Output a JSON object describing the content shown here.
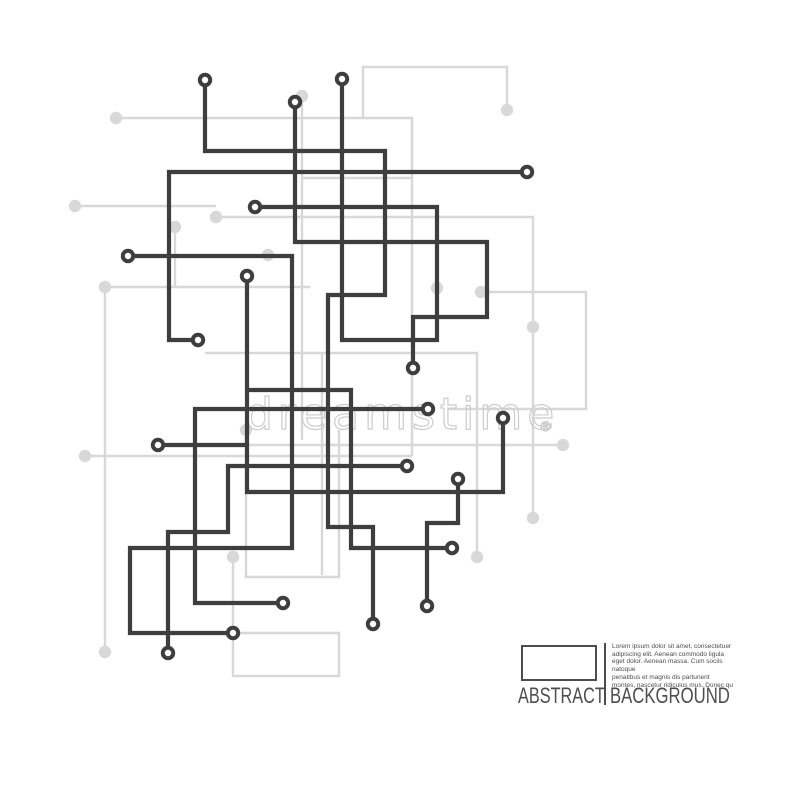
{
  "circuit": {
    "colors": {
      "dark": "#3e3e3e",
      "light": "#d8d8d8",
      "node_fill": "#ffffff",
      "watermark": "#cccccc",
      "caption": "#4d4d4d",
      "background": "#ffffff"
    },
    "dark_line_width": 4.2,
    "light_line_width": 2.4,
    "dark_traces": [
      {
        "name": "trace-top-left-hook",
        "points": [
          [
            205,
            80
          ],
          [
            205,
            151
          ],
          [
            385,
            151
          ],
          [
            385,
            295
          ],
          [
            328,
            295
          ],
          [
            328,
            527
          ],
          [
            373,
            527
          ],
          [
            373,
            624
          ]
        ]
      },
      {
        "name": "trace-center-drop",
        "points": [
          [
            342,
            79
          ],
          [
            342,
            340
          ],
          [
            437,
            340
          ],
          [
            437,
            207
          ],
          [
            255,
            207
          ]
        ]
      },
      {
        "name": "trace-step-rect",
        "points": [
          [
            295,
            102
          ],
          [
            295,
            242
          ],
          [
            487,
            242
          ],
          [
            487,
            317
          ],
          [
            413,
            317
          ],
          [
            413,
            368
          ]
        ]
      },
      {
        "name": "trace-wide-L",
        "points": [
          [
            198,
            340
          ],
          [
            169,
            340
          ],
          [
            169,
            172
          ],
          [
            527,
            172
          ]
        ]
      },
      {
        "name": "trace-left-long",
        "points": [
          [
            128,
            256
          ],
          [
            292,
            256
          ],
          [
            292,
            548
          ],
          [
            130,
            548
          ],
          [
            130,
            633
          ],
          [
            233,
            633
          ]
        ]
      },
      {
        "name": "trace-mid-horizontal",
        "points": [
          [
            428,
            409
          ],
          [
            195,
            409
          ],
          [
            195,
            603
          ],
          [
            283,
            603
          ]
        ]
      },
      {
        "name": "trace-small-hook",
        "points": [
          [
            458,
            479
          ],
          [
            458,
            523
          ],
          [
            427,
            523
          ],
          [
            427,
            606
          ]
        ]
      },
      {
        "name": "trace-crossbar",
        "points": [
          [
            247,
            390
          ],
          [
            351,
            390
          ],
          [
            351,
            548
          ],
          [
            452,
            548
          ]
        ]
      },
      {
        "name": "trace-lower-left-hook",
        "points": [
          [
            407,
            466
          ],
          [
            228,
            466
          ],
          [
            228,
            532
          ],
          [
            168,
            532
          ],
          [
            168,
            653
          ]
        ]
      },
      {
        "name": "trace-stub",
        "points": [
          [
            158,
            445
          ],
          [
            247,
            445
          ]
        ]
      },
      {
        "name": "trace-u-shape",
        "points": [
          [
            247,
            276
          ],
          [
            247,
            492
          ],
          [
            503,
            492
          ],
          [
            503,
            418
          ]
        ]
      }
    ],
    "dark_nodes": [
      [
        205,
        80
      ],
      [
        342,
        79
      ],
      [
        295,
        102
      ],
      [
        527,
        172
      ],
      [
        255,
        207
      ],
      [
        128,
        256
      ],
      [
        247,
        276
      ],
      [
        198,
        340
      ],
      [
        413,
        368
      ],
      [
        428,
        409
      ],
      [
        503,
        418
      ],
      [
        158,
        445
      ],
      [
        407,
        466
      ],
      [
        458,
        479
      ],
      [
        452,
        548
      ],
      [
        283,
        603
      ],
      [
        427,
        606
      ],
      [
        373,
        624
      ],
      [
        233,
        633
      ],
      [
        168,
        653
      ]
    ],
    "light_traces": [
      {
        "points": [
          [
            116,
            118
          ],
          [
            412,
            118
          ],
          [
            412,
            456
          ]
        ]
      },
      {
        "points": [
          [
            302,
            96
          ],
          [
            302,
            440
          ]
        ]
      },
      {
        "points": [
          [
            363,
            117
          ],
          [
            363,
            67
          ],
          [
            507,
            67
          ],
          [
            507,
            110
          ]
        ]
      },
      {
        "points": [
          [
            75,
            206
          ],
          [
            216,
            206
          ]
        ]
      },
      {
        "points": [
          [
            216,
            217
          ],
          [
            533,
            217
          ],
          [
            533,
            408
          ]
        ]
      },
      {
        "points": [
          [
            448,
            409
          ],
          [
            586,
            409
          ],
          [
            586,
            292
          ],
          [
            481,
            292
          ]
        ]
      },
      {
        "points": [
          [
            533,
            408
          ],
          [
            533,
            518
          ]
        ]
      },
      {
        "points": [
          [
            85,
            456
          ],
          [
            412,
            456
          ]
        ]
      },
      {
        "points": [
          [
            246,
            430
          ],
          [
            246,
            577
          ],
          [
            339,
            577
          ],
          [
            339,
            430
          ]
        ]
      },
      {
        "points": [
          [
            233,
            557
          ],
          [
            233,
            676
          ],
          [
            339,
            676
          ],
          [
            339,
            633
          ],
          [
            238,
            633
          ]
        ]
      },
      {
        "points": [
          [
            310,
            287
          ],
          [
            105,
            287
          ],
          [
            105,
            652
          ]
        ]
      },
      {
        "points": [
          [
            412,
            178
          ],
          [
            303,
            178
          ]
        ]
      },
      {
        "points": [
          [
            205,
            353
          ],
          [
            477,
            353
          ],
          [
            477,
            557
          ]
        ]
      },
      {
        "points": [
          [
            322,
            353
          ],
          [
            322,
            575
          ]
        ]
      },
      {
        "points": [
          [
            247,
            445
          ],
          [
            563,
            445
          ]
        ]
      },
      {
        "points": [
          [
            175,
            227
          ],
          [
            175,
            287
          ]
        ]
      }
    ],
    "light_nodes": [
      [
        116,
        118
      ],
      [
        302,
        96
      ],
      [
        507,
        110
      ],
      [
        75,
        206
      ],
      [
        216,
        217
      ],
      [
        175,
        227
      ],
      [
        268,
        255
      ],
      [
        105,
        287
      ],
      [
        481,
        292
      ],
      [
        437,
        288
      ],
      [
        533,
        327
      ],
      [
        246,
        430
      ],
      [
        85,
        456
      ],
      [
        563,
        445
      ],
      [
        533,
        518
      ],
      [
        477,
        557
      ],
      [
        233,
        557
      ],
      [
        105,
        652
      ]
    ]
  },
  "watermark": {
    "text": "dreamstime",
    "registered": "®"
  },
  "caption": {
    "title_left": "ABSTRACT",
    "title_right": "BACKGROUND",
    "lorem_lines": [
      "Lorem ipsum dolor sit amet, consectetuer",
      "adipiscing elit. Aenean commodo ligula",
      "eget dolor. Aenean massa. Cum sociis natoque",
      "penatibus et magnis dis parturient",
      "montes, nascetur ridiculus mus. Donec qu"
    ]
  }
}
